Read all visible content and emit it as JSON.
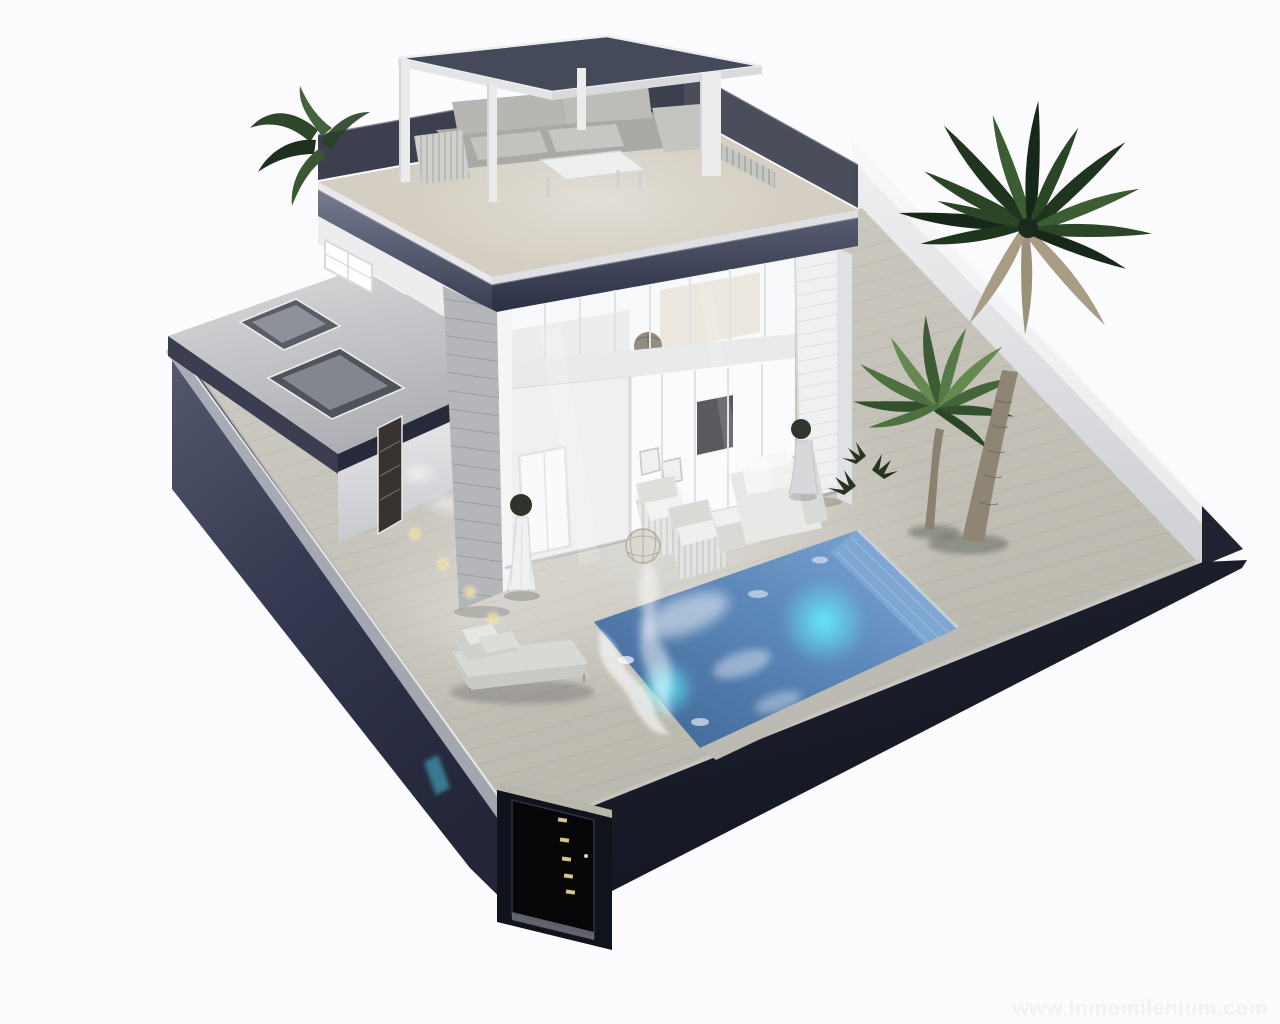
{
  "image": {
    "type": "3D architectural render",
    "style": "isometric aerial cutaway on white background, evening interior lighting",
    "subject": "Modern two-storey white villa with rooftop solarium and pergola, glazed facade, covered lounge terrace, private pool with underwater lights, timber deck, palm garden and dark perimeter wall with entrance gate"
  },
  "watermark": {
    "text": "www.inmomilenium.com"
  },
  "palette": {
    "background": "#fcfcfe",
    "plinth-dark": "#161925",
    "plinth-mid": "#3a3e52",
    "roof-fascia": "#454a5e",
    "wall-white": "#f2f2f4",
    "siding-gray": "#b4b6ba",
    "deck": "#c8c5bb",
    "terrace-floor": "#d3cdc1",
    "pool-deep": "#41699a",
    "pool-shallow": "#7ea6d2",
    "pool-glow": "#59e2f8",
    "grass": "#76994e",
    "palm-dark": "#1d2b1b",
    "palm-light": "#5d7d4b",
    "sofa-gray": "#b0b0ad",
    "furniture-white": "#eaeae8",
    "gate-black": "#060608",
    "gate-light": "#d9c87e",
    "watermark": "#f2f2f5"
  },
  "scene": {
    "storeys": 2,
    "palm_trees_count": 3,
    "ground_lights_count": 4,
    "gate_lights_count": 5,
    "underwater_lights_count": 2
  }
}
